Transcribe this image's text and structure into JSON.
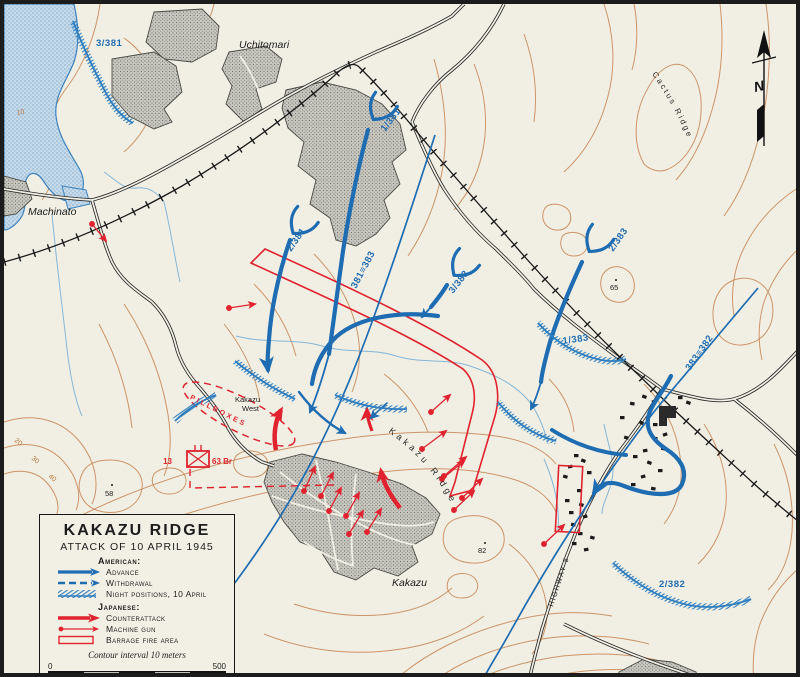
{
  "legend": {
    "title": "KAKAZU RIDGE",
    "subtitle": "ATTACK OF 10 APRIL 1945",
    "american_header": "American:",
    "advance": "Advance",
    "withdrawal": "Withdrawal",
    "night_positions": "Night positions, 10 April",
    "japanese_header": "Japanese:",
    "counterattack": "Counterattack",
    "machine_gun": "Machine gun",
    "barrage": "Barrage fire area",
    "contour_note": "Contour interval 10 meters",
    "scale_start": "0",
    "scale_end": "500",
    "scale_units": "YARDS"
  },
  "units": {
    "u3_381": "3/381",
    "u1_381": "1/381",
    "u2_381": "2/381",
    "b381_383": "381≡383",
    "u3_383": "3/383",
    "u2_383": "2/383",
    "u1_383": "1/383",
    "b383_382": "383≡382",
    "u2_382": "2/382",
    "jp_num": "13",
    "jp_brigade": "63 Br"
  },
  "places": {
    "uchitomari": "Uchitomari",
    "machinato": "Machinato",
    "kakazu": "Kakazu",
    "kakazu_west_line1": "Kakazu",
    "kakazu_west_line2": "West",
    "kakazu_ridge": "Kakazu Ridge",
    "cactus_ridge": "Cactus Ridge",
    "pillboxes": "PILLBOXES",
    "highway": "HIGHWAY 5"
  },
  "elevations": {
    "h65": "65",
    "h82": "82",
    "h58": "58"
  },
  "contour_labels": {
    "c10": "10",
    "c20": "20",
    "c30": "30",
    "c40": "40"
  },
  "compass": {
    "north": "N"
  },
  "colors": {
    "american_blue": "#1e6cb2",
    "japanese_red": "#e0232f",
    "contour_tan": "#c9895a",
    "water_blue": "#a9c9e0",
    "town_gray": "#c2c1bb",
    "paper": "#f1efe4",
    "frame": "#1c1c1c"
  }
}
